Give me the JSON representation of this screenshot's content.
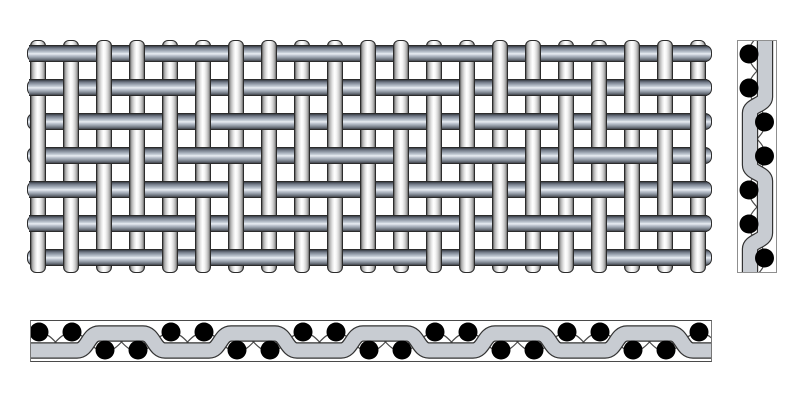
{
  "canvas": {
    "width": 800,
    "height": 400,
    "background": "#ffffff"
  },
  "colors": {
    "wire_outline": "#2b2b2b",
    "weft_gradient": "#383d44 0%, #707886 14%, #9ea7b3 30%, #c8cfd9 44%, #e9edf3 52%, #c2c9d3 62%, #98a0ac 76%, #6a717b 90%, #42464d 100%",
    "warp_gradient": "#5a5a5a 0%, #b0b0b0 12%, #e2e2e2 30%, #ffffff 46%, #f8f8f8 58%, #e0e0e0 72%, #b4b4b4 88%, #6a6a6a 100%",
    "ribbon_fill": "#c8ccd2",
    "ribbon_outline": "#333333",
    "dot_color": "#000000",
    "thin_wire_color": "#4a4a4a"
  },
  "mesh_face": {
    "left": 27,
    "top": 40,
    "width": 685,
    "height": 233,
    "warp": {
      "count": 21,
      "first_center": 38,
      "spacing": 33,
      "width": 16,
      "top": 40,
      "bottom": 273
    },
    "weft": {
      "count": 7,
      "first_center": 53,
      "spacing": 34,
      "height": 17,
      "left": 27,
      "right": 712
    },
    "weave": {
      "repeat": 4,
      "weft_over_sum_mod": [
        0,
        1
      ]
    }
  },
  "warp_cross_section": {
    "left": 737,
    "top": 40,
    "width": 40,
    "height": 233,
    "ribbon": {
      "thickness": 14,
      "right_center_x": 27,
      "left_center_x": 12,
      "first_transition": 56,
      "period": 68,
      "transition_len": 16,
      "start_side": "right"
    },
    "dots": {
      "count": 7,
      "first_center_y": 13,
      "spacing": 34,
      "radius": 9.5,
      "side_pattern": [
        "left",
        "left",
        "right",
        "right"
      ],
      "left_x": 11,
      "right_x": 26.5
    },
    "thin_wires": {
      "stroke_width": 1.2,
      "x_a": 27,
      "x_b": 11,
      "ctrl": 17
    }
  },
  "weft_cross_section": {
    "left": 30,
    "top": 320,
    "width": 682,
    "height": 42,
    "ribbon": {
      "thickness": 14,
      "low_center_y": 29.5,
      "high_center_y": 12.5,
      "first_transition": 46,
      "period": 66,
      "transition_len": 22,
      "start_level": "low"
    },
    "dots": {
      "count": 21,
      "first_center_x": 8,
      "spacing": 33,
      "radius": 9.5,
      "top_pattern": [
        "top",
        "top",
        "bottom",
        "bottom"
      ],
      "top_y": 11,
      "bottom_y": 29
    },
    "thin_wires": {
      "stroke_width": 1.2,
      "y_a": 12,
      "y_b": 30,
      "ctrl": 16
    }
  }
}
